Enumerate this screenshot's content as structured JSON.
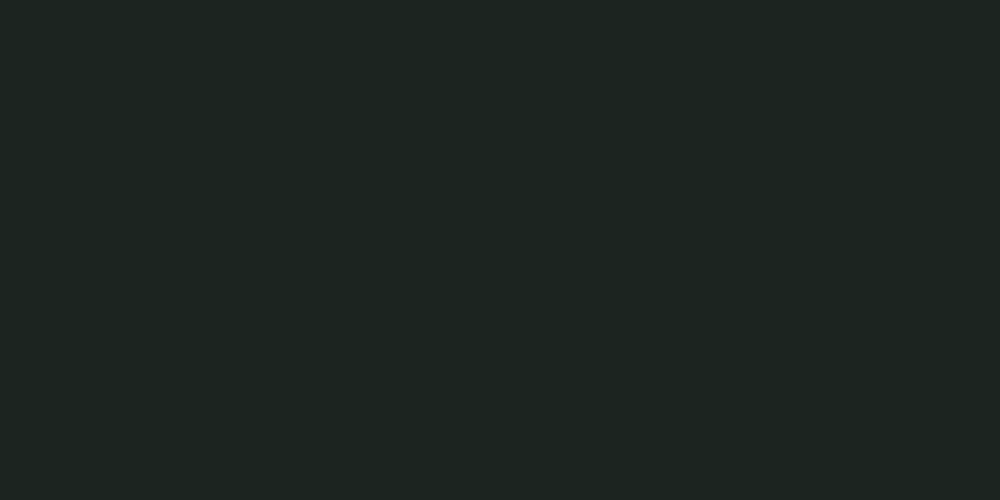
{
  "meta": {
    "title": "Aerial rendering of a campus master plan",
    "description": "Bird's-eye architectural visualization: a white headquarters tower with a red-flag courtyard, low white teaching blocks, a red running track with striped green pitch, a stepped plaza with square planters, tree-lined parking lots, a triple-gable logistics hall with red market tents, a curving west avenue with a yellow centre line, and a wide south highway junction with a bus lane, all set in rolling mist-covered woodland with autumn trees."
  },
  "palette": {
    "terrain_top": "#bdd2c8",
    "terrain_upper": "#a6bb9f",
    "terrain_mid": "#8ea687",
    "terrain_low": "#7f976f",
    "forest_mist1": "#a7bfae",
    "forest_mist2": "#97b19d",
    "forest_mist3": "#b6cab9",
    "forest_mid1": "#84a083",
    "forest_mid2": "#769372",
    "forest_deep": "#65805f",
    "forest_olive1": "#8d9c6a",
    "forest_olive2": "#7d8f5c",
    "forest_dark1": "#36462e",
    "forest_dark2": "#2b3a24",
    "forest_dark3": "#42532f",
    "park_tree1": "#4c6339",
    "park_tree2": "#5b7547",
    "park_lawn": "#5f7850",
    "park_lawn2": "#85a061",
    "meadow_light": "#b7c4a8",
    "meadow_tan": "#c9b98b",
    "meadow_warm": "#d9c794",
    "sun_glow": "#fff3d8",
    "cloud": "#ffffff",
    "haze": "#eef4f0",
    "road_asphalt": "#5e6268",
    "highway_asphalt": "#6b6f75",
    "road_edge": "#4f5257",
    "lane_white": "#edeff1",
    "lane_yellow": "#d8c654",
    "median_green": "#718c54",
    "campus_paving": "#cdd1d5",
    "plaza_light": "#dbdee1",
    "lot_gray": "#999fa6",
    "yard_asphalt": "#757a81",
    "path_tan": "#cfc39c",
    "bld_white": "#f4f6f8",
    "bld_shade": "#c9d0d7",
    "bld_face": "#e7edf2",
    "fin_line": "#b7c2cd",
    "roof_dark": "#46515d",
    "roof_grid": "#5d6874",
    "roof_light": "#dfe4e9",
    "roof_panel": "#d5dade",
    "ridge_white": "#f9fbfc",
    "skylight": "#8fc2de",
    "stripe_blue": "#4e7fc0",
    "track_lane": "#c8704f",
    "infield": "#88b35d",
    "infield_stripe": "#9ac16f",
    "planter": "#8fb05c",
    "planter_dark": "#6d9044",
    "tree_green": "#5d7b46",
    "tree_green_dark": "#466032",
    "tree_gold": "#dca342",
    "tree_orange": "#d8822f",
    "shadow": "#1f2a22",
    "car_white": "#eef1f3",
    "car_silver": "#b9bfc5",
    "car_dark": "#3c4148",
    "car_blue": "#5d81ad",
    "flag_red": "#cf3b2a",
    "tent_red": "#c85f55",
    "tent_white": "#eceeef",
    "fence_white": "#e9edf0",
    "figure_dark": "#2f353b",
    "courtyard_lawn": "#7d9a5e"
  },
  "scene": {
    "landmarks": [
      {
        "id": "logistics-hall",
        "label": "triple-gable logistics hall with loading yard"
      },
      {
        "id": "market-tents",
        "label": "red roadside market tents"
      },
      {
        "id": "fenced-parking-lot",
        "label": "fenced parking lot with car rows"
      },
      {
        "id": "golden-tree-parking",
        "label": "parking grove with golden autumn trees"
      },
      {
        "id": "stepped-plaza",
        "label": "stepped plaza with square green planters"
      },
      {
        "id": "running-track",
        "label": "red running track with striped green pitch"
      },
      {
        "id": "headquarters-tower",
        "label": "white mid-rise tower with solar roof"
      },
      {
        "id": "flag-courtyard",
        "label": "lawn courtyard with red flag"
      },
      {
        "id": "teaching-blocks",
        "label": "stepped row of low white blocks"
      },
      {
        "id": "blue-stripe-hall",
        "label": "hall with blue glass stripes and flag"
      },
      {
        "id": "west-avenue",
        "label": "curving avenue with yellow centre line"
      },
      {
        "id": "south-highway",
        "label": "wide dual-carriageway with green median"
      },
      {
        "id": "gate-boulevard",
        "label": "junction branch with bus lane and zebra crossing"
      },
      {
        "id": "woodland",
        "label": "mist-covered rolling woodland"
      }
    ],
    "flags": {
      "count": 2
    },
    "vehicle_counts": {
      "highway": 19,
      "west_avenue": 11,
      "gate_boulevard": 6,
      "bus": 1
    },
    "clouds_count": 11,
    "autumn_trees": true,
    "people_visible": true
  }
}
